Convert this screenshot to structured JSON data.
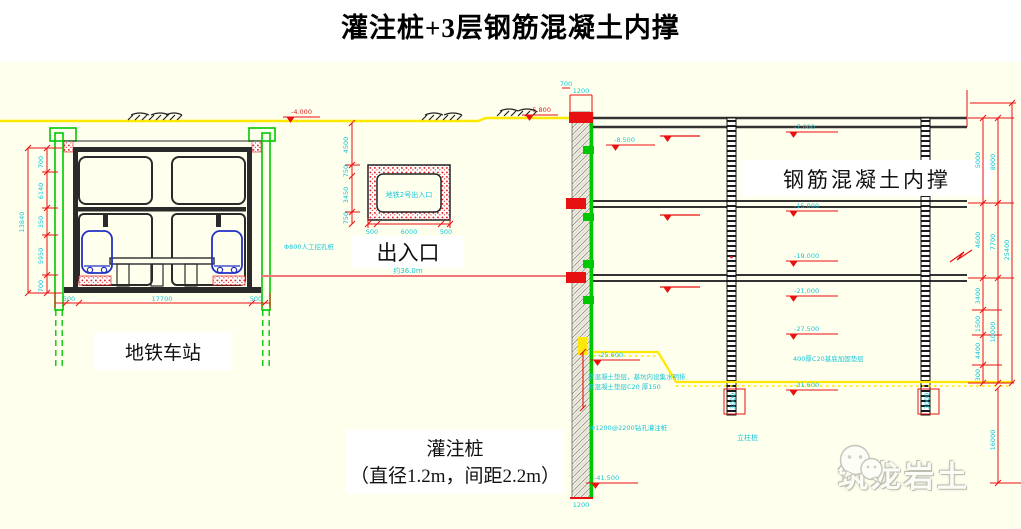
{
  "title": "灌注桩+3层钢筋混凝土内撑",
  "labels": {
    "station": "地铁车站",
    "exit": "出入口",
    "exit_box": "地铁2号出入口",
    "bracing": "钢筋混凝土内撑",
    "pile_caption_line1": "灌注桩",
    "pile_caption_line2": "（直径1.2m，间距2.2m）",
    "king_post": "立柱桩",
    "watermark": "筑龙岩土",
    "span_note": "约36.0m",
    "manual_pile_note": "Φ800人工挖孔桩",
    "bored_pile_note": "Φ1200@2200钻孔灌注桩",
    "cushion_note_line1": "素混凝土垫层，基坑内设集水明排",
    "cushion_note_line2": "素混凝土垫层C20 厚150",
    "base_note": "400厚C20基底加固垫层"
  },
  "elevations": {
    "ground_left": "-4.000",
    "ground_right": "-5.800",
    "wall_upper": "-8.500",
    "level1": "-7.000",
    "level2": "-15.000",
    "level3": "-19.000",
    "level4": "-21.000",
    "level5": "-27.500",
    "berm": "-25.600",
    "dig": "-31.600",
    "wall_bottom": "-41.500"
  },
  "dims": {
    "station_left": [
      "700",
      "6140",
      "350",
      "5950",
      "700"
    ],
    "station_left_total": "13840",
    "station_bottom": [
      "500",
      "17700",
      "500"
    ],
    "exit_left": [
      "4500",
      "750",
      "3450",
      "750"
    ],
    "exit_bottom": [
      "500",
      "6000",
      "500"
    ],
    "wall_top": [
      "700",
      "1200"
    ],
    "wall_bottom_width": "1200",
    "kingpost_embed": "3000",
    "right_inner": [
      "5000",
      "4600",
      "3400",
      "1500",
      "4400",
      "300"
    ],
    "right_mid": [
      "8000",
      "7700",
      "10000"
    ],
    "right_total": "25400",
    "pile_embed": "16000"
  },
  "colors": {
    "canvas": "#FFFFEE",
    "cad_red": "#E81111",
    "cad_cyan": "#19C6D8",
    "cad_green": "#00C800",
    "cad_yellow": "#FFE800",
    "cad_blue": "#2330C8",
    "salmon_line": "#F07878"
  }
}
